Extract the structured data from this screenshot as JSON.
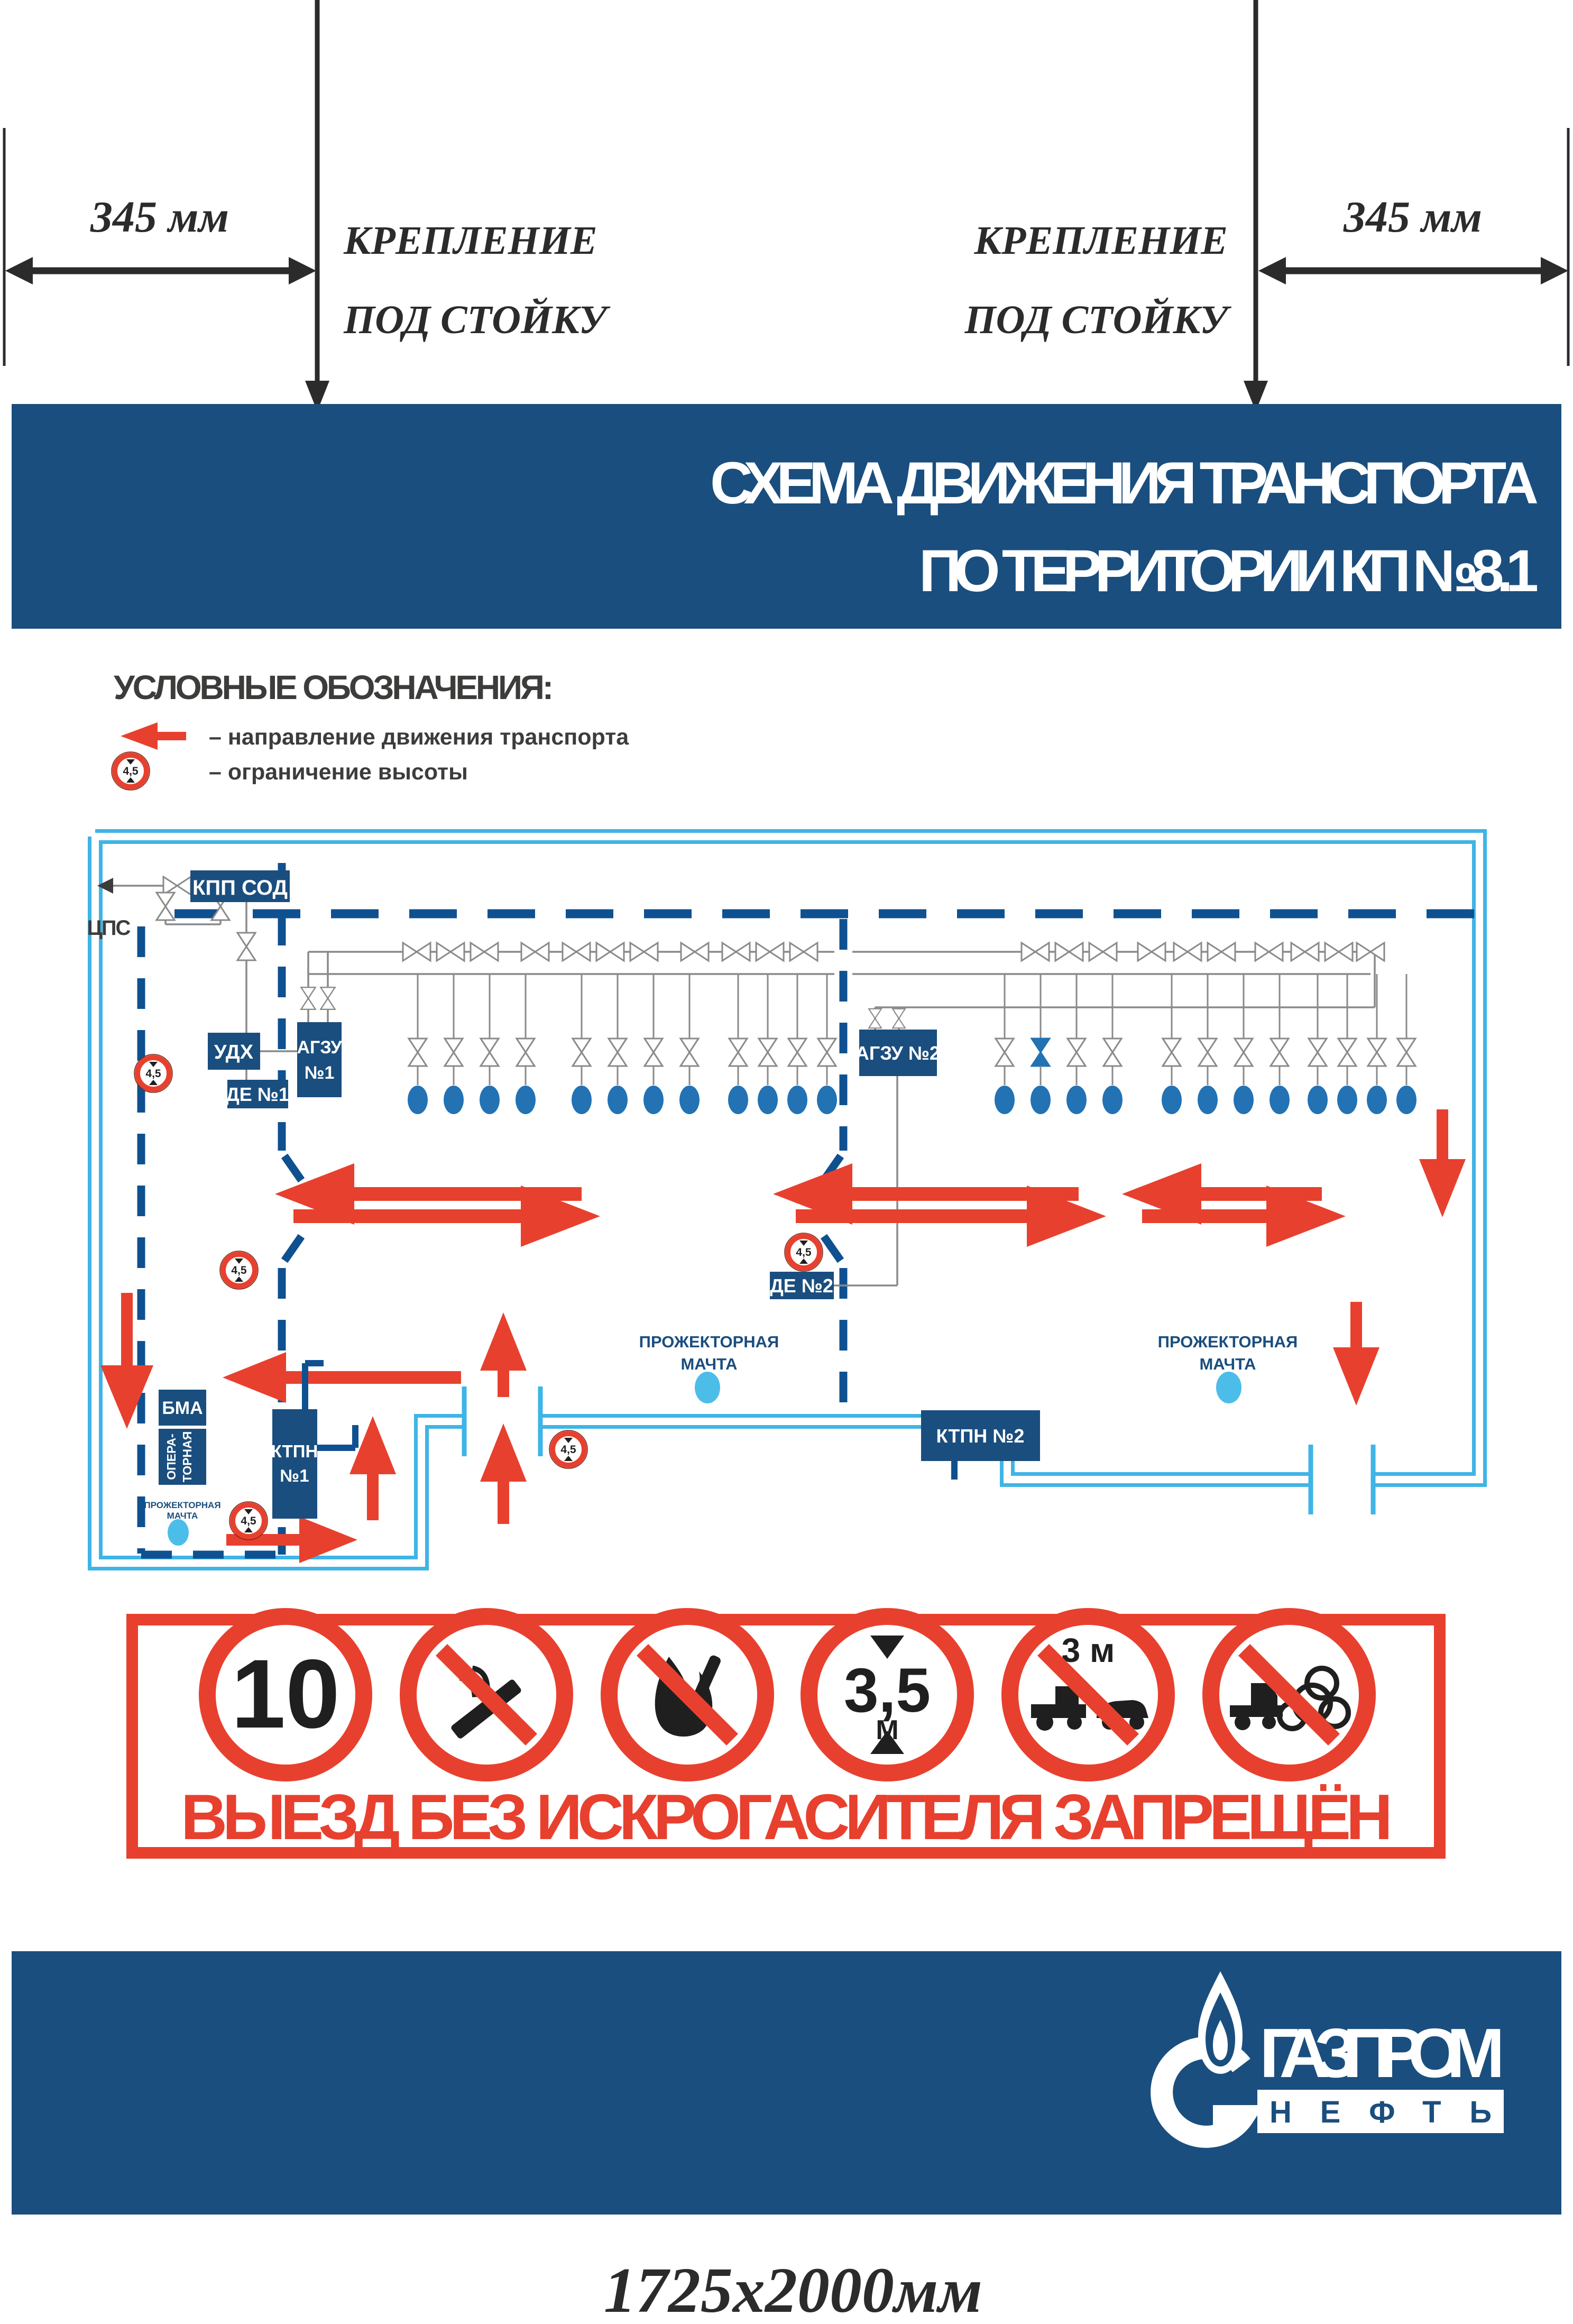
{
  "dimensions": {
    "left_value": "345 мм",
    "right_value": "345 мм",
    "mount_line1": "КРЕПЛЕНИЕ",
    "mount_line2": "ПОД СТОЙКУ",
    "board_size": "1725x2000мм"
  },
  "header": {
    "line1": "СХЕМА ДВИЖЕНИЯ ТРАНСПОРТА",
    "line2": "ПО ТЕРРИТОРИИ КП №8.1"
  },
  "legend": {
    "title": "УСЛОВНЫЕ ОБОЗНАЧЕНИЯ:",
    "arrow_label": "– направление движения транспорта",
    "height_label": "– ограничение высоты"
  },
  "height_sign": {
    "value": "4,5",
    "unit": "м"
  },
  "facilities": {
    "cps": "ЦПС",
    "kpp": "КПП СОД",
    "udh": "УДХ",
    "agzu1_l1": "АГЗУ",
    "agzu1_l2": "№1",
    "de1": "ДЕ №1",
    "agzu2": "АГЗУ №2",
    "de2": "ДЕ №2",
    "bma": "БМА",
    "oper_l1": "ОПЕРА-",
    "oper_l2": "ТОРНАЯ",
    "ktpn1_l1": "КТПН",
    "ktpn1_l2": "№1",
    "ktpn2": "КТПН №2",
    "mast_l1": "ПРОЖЕКТОРНАЯ",
    "mast_l2": "МАЧТА"
  },
  "prohibition": {
    "speed": "10",
    "height_value": "3,5",
    "height_unit": "М",
    "tow_distance": "3 м",
    "warning": "ВЫЕЗД БЕЗ ИСКРОГАСИТЕЛЯ ЗАПРЕЩЁН"
  },
  "brand": {
    "name": "ГАЗПРОМ",
    "sub": "НЕФТЬ"
  },
  "colors": {
    "brand_blue": "#1a4e7e",
    "road_blue": "#0f5190",
    "fence_cyan": "#3fb4e6",
    "mast_light_blue": "#4cbde8",
    "red": "#e8402e",
    "wellhead_blue": "#2272b4",
    "pipe_gray": "#8a8a8a",
    "text_dark": "#3c3c3b"
  }
}
